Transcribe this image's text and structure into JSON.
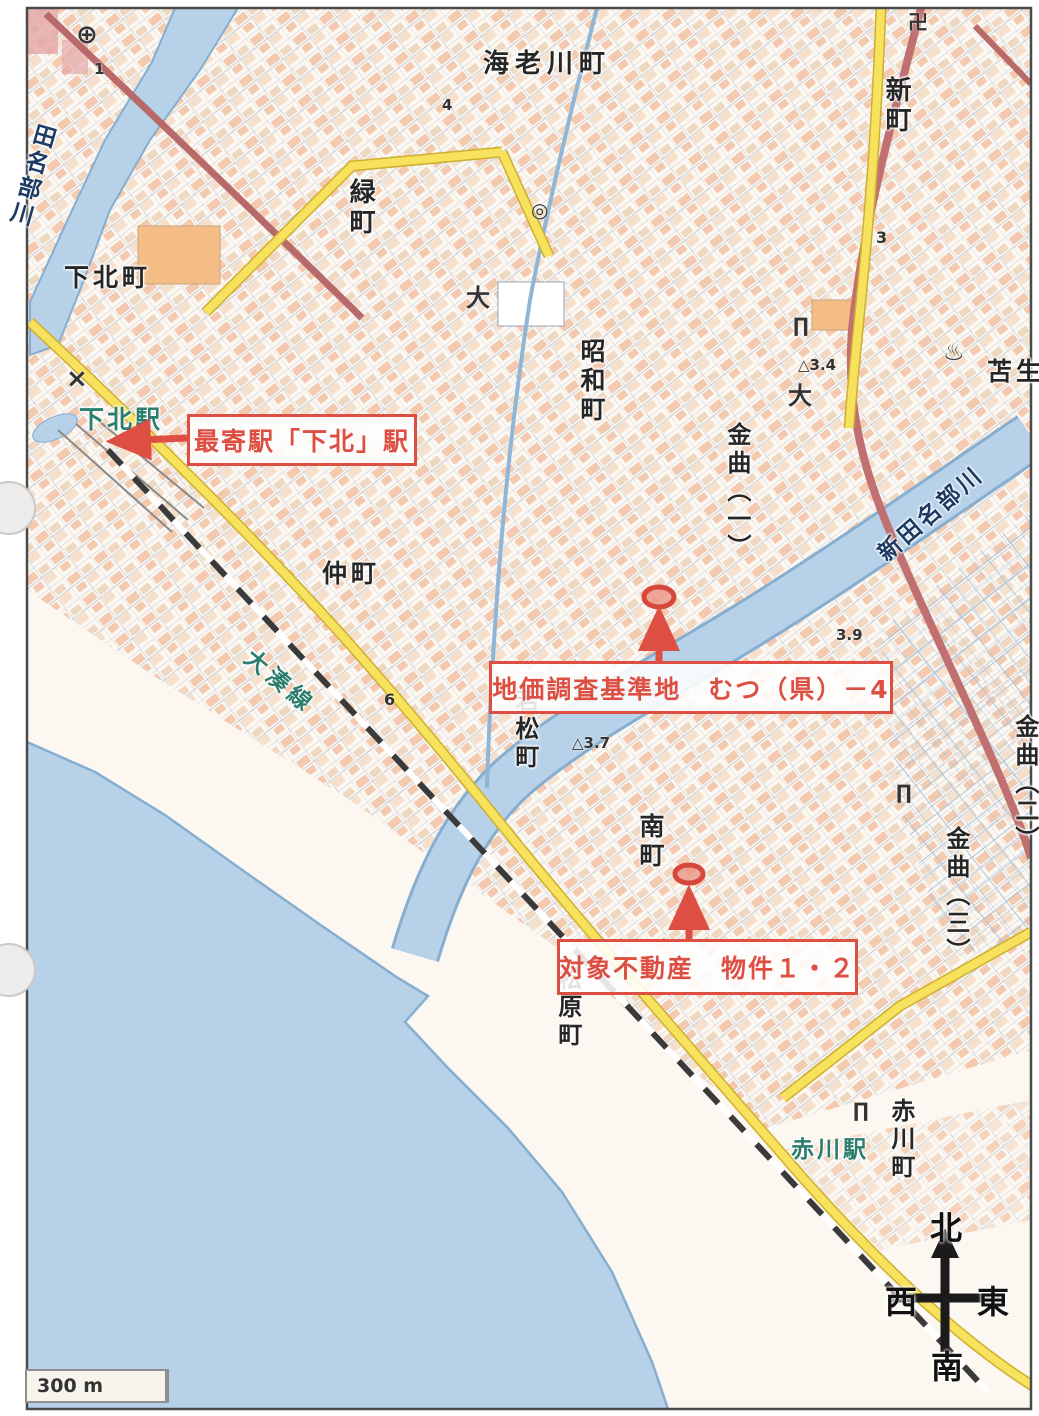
{
  "colors": {
    "annotation": "#dd4f42",
    "water": "#b7d2e8",
    "land": "#fcf8f1",
    "station_text": "#2b7d6d",
    "river_text": "#1d3a63"
  },
  "scalebar": {
    "label": "300 m"
  },
  "compass": {
    "north": "北",
    "south": "南",
    "east": "東",
    "west": "西"
  },
  "annotations": [
    {
      "id": "nearest-station",
      "text": "最寄駅「下北」駅",
      "x": 187,
      "y": 414,
      "w": 224,
      "h": 46
    },
    {
      "id": "survey-point",
      "text": "地価調査基準地　むつ（県）－4",
      "x": 489,
      "y": 661,
      "w": 398,
      "h": 47
    },
    {
      "id": "subject-property",
      "text": "対象不動産　物件１・２",
      "x": 557,
      "y": 939,
      "w": 295,
      "h": 50
    }
  ],
  "places": [
    {
      "name": "ebikawa-cho",
      "text": "海老川町",
      "x": 483,
      "y": 50,
      "v": false,
      "size": 26,
      "ls": 6
    },
    {
      "name": "shin-machi",
      "text": "新町",
      "x": 881,
      "y": 76,
      "v": true,
      "size": 26
    },
    {
      "name": "midori-machi",
      "text": "緑町",
      "x": 345,
      "y": 178,
      "v": true,
      "size": 26
    },
    {
      "name": "shimokita-cho",
      "text": "下北町",
      "x": 64,
      "y": 264,
      "v": false,
      "size": 25,
      "ls": 4
    },
    {
      "name": "showa-cho",
      "text": "昭和町",
      "x": 577,
      "y": 338,
      "v": true,
      "size": 25
    },
    {
      "name": "kanemagari-1",
      "text": "金曲（一）",
      "x": 723,
      "y": 422,
      "v": true,
      "size": 24
    },
    {
      "name": "tomau",
      "text": "苫生",
      "x": 987,
      "y": 358,
      "v": false,
      "size": 25,
      "ls": 4
    },
    {
      "name": "naka-machi",
      "text": "仲町",
      "x": 322,
      "y": 560,
      "v": false,
      "size": 25,
      "ls": 4
    },
    {
      "name": "wakamatsu-cho",
      "text": "若松町",
      "x": 511,
      "y": 688,
      "v": true,
      "size": 24
    },
    {
      "name": "minami-machi",
      "text": "南町",
      "x": 636,
      "y": 813,
      "v": true,
      "size": 25
    },
    {
      "name": "matsubara-cho",
      "text": "松原町",
      "x": 554,
      "y": 966,
      "v": true,
      "size": 24
    },
    {
      "name": "akagawa-cho",
      "text": "赤川町",
      "x": 887,
      "y": 1098,
      "v": true,
      "size": 24
    },
    {
      "name": "kanemagari-2",
      "text": "金曲（二）",
      "x": 1011,
      "y": 714,
      "v": true,
      "size": 24
    },
    {
      "name": "kanemagari-3",
      "text": "金曲（三）",
      "x": 942,
      "y": 826,
      "v": true,
      "size": 24
    },
    {
      "name": "tanabu-river",
      "text": "田名部川",
      "x": 32,
      "y": 120,
      "v": true,
      "size": 23,
      "color": "#1d3a63",
      "rot": 16
    },
    {
      "name": "shin-tanabu-river",
      "text": "新田名部川",
      "x": 874,
      "y": 548,
      "v": false,
      "size": 23,
      "color": "#1d3a63",
      "rot": -41,
      "ls": 3
    },
    {
      "name": "ominato-line",
      "text": "大湊線",
      "x": 255,
      "y": 646,
      "v": false,
      "size": 23,
      "color": "#2b7d6d",
      "rot": 40,
      "ls": 5
    },
    {
      "name": "shimokita-station",
      "text": "下北駅",
      "x": 79,
      "y": 406,
      "v": false,
      "size": 25,
      "color": "#2b7d6d",
      "ls": 3
    },
    {
      "name": "akagawa-station",
      "text": "赤川駅",
      "x": 791,
      "y": 1138,
      "v": false,
      "size": 23,
      "color": "#2b7d6d",
      "ls": 3
    }
  ],
  "symbols": [
    {
      "name": "hospital-icon",
      "text": "⊕",
      "x": 76,
      "y": 20,
      "size": 26
    },
    {
      "name": "temple-icon",
      "text": "卍",
      "x": 908,
      "y": 6,
      "size": 20
    },
    {
      "name": "hot-spring-icon",
      "text": "♨",
      "x": 943,
      "y": 338,
      "size": 24
    },
    {
      "name": "police-icon",
      "text": "×",
      "x": 66,
      "y": 364,
      "size": 26
    },
    {
      "name": "kanji-dai-mark",
      "text": "大",
      "x": 466,
      "y": 278,
      "size": 24
    },
    {
      "name": "kanji-dai-mark-2",
      "text": "大",
      "x": 788,
      "y": 376,
      "size": 24
    },
    {
      "name": "elevation-mark-1",
      "text": "△3.4",
      "x": 798,
      "y": 356,
      "size": 15
    },
    {
      "name": "elevation-mark-2",
      "text": "△3.7",
      "x": 572,
      "y": 734,
      "size": 15
    },
    {
      "name": "elevation-mark-3",
      "text": "3.9",
      "x": 836,
      "y": 626,
      "size": 15
    },
    {
      "name": "road-number-6",
      "text": "6",
      "x": 384,
      "y": 690,
      "size": 16
    },
    {
      "name": "road-number-3",
      "text": "3",
      "x": 876,
      "y": 228,
      "size": 16
    },
    {
      "name": "point-number-1",
      "text": "1",
      "x": 94,
      "y": 60,
      "size": 15
    },
    {
      "name": "point-number-4",
      "text": "4",
      "x": 442,
      "y": 96,
      "size": 15
    },
    {
      "name": "torii-icon-1",
      "text": "∏",
      "x": 793,
      "y": 313,
      "size": 20
    },
    {
      "name": "torii-icon-2",
      "text": "∏",
      "x": 896,
      "y": 780,
      "size": 20
    },
    {
      "name": "torii-icon-3",
      "text": "∏",
      "x": 853,
      "y": 1098,
      "size": 20
    },
    {
      "name": "building-mark",
      "text": "◎",
      "x": 531,
      "y": 198,
      "size": 20
    }
  ]
}
